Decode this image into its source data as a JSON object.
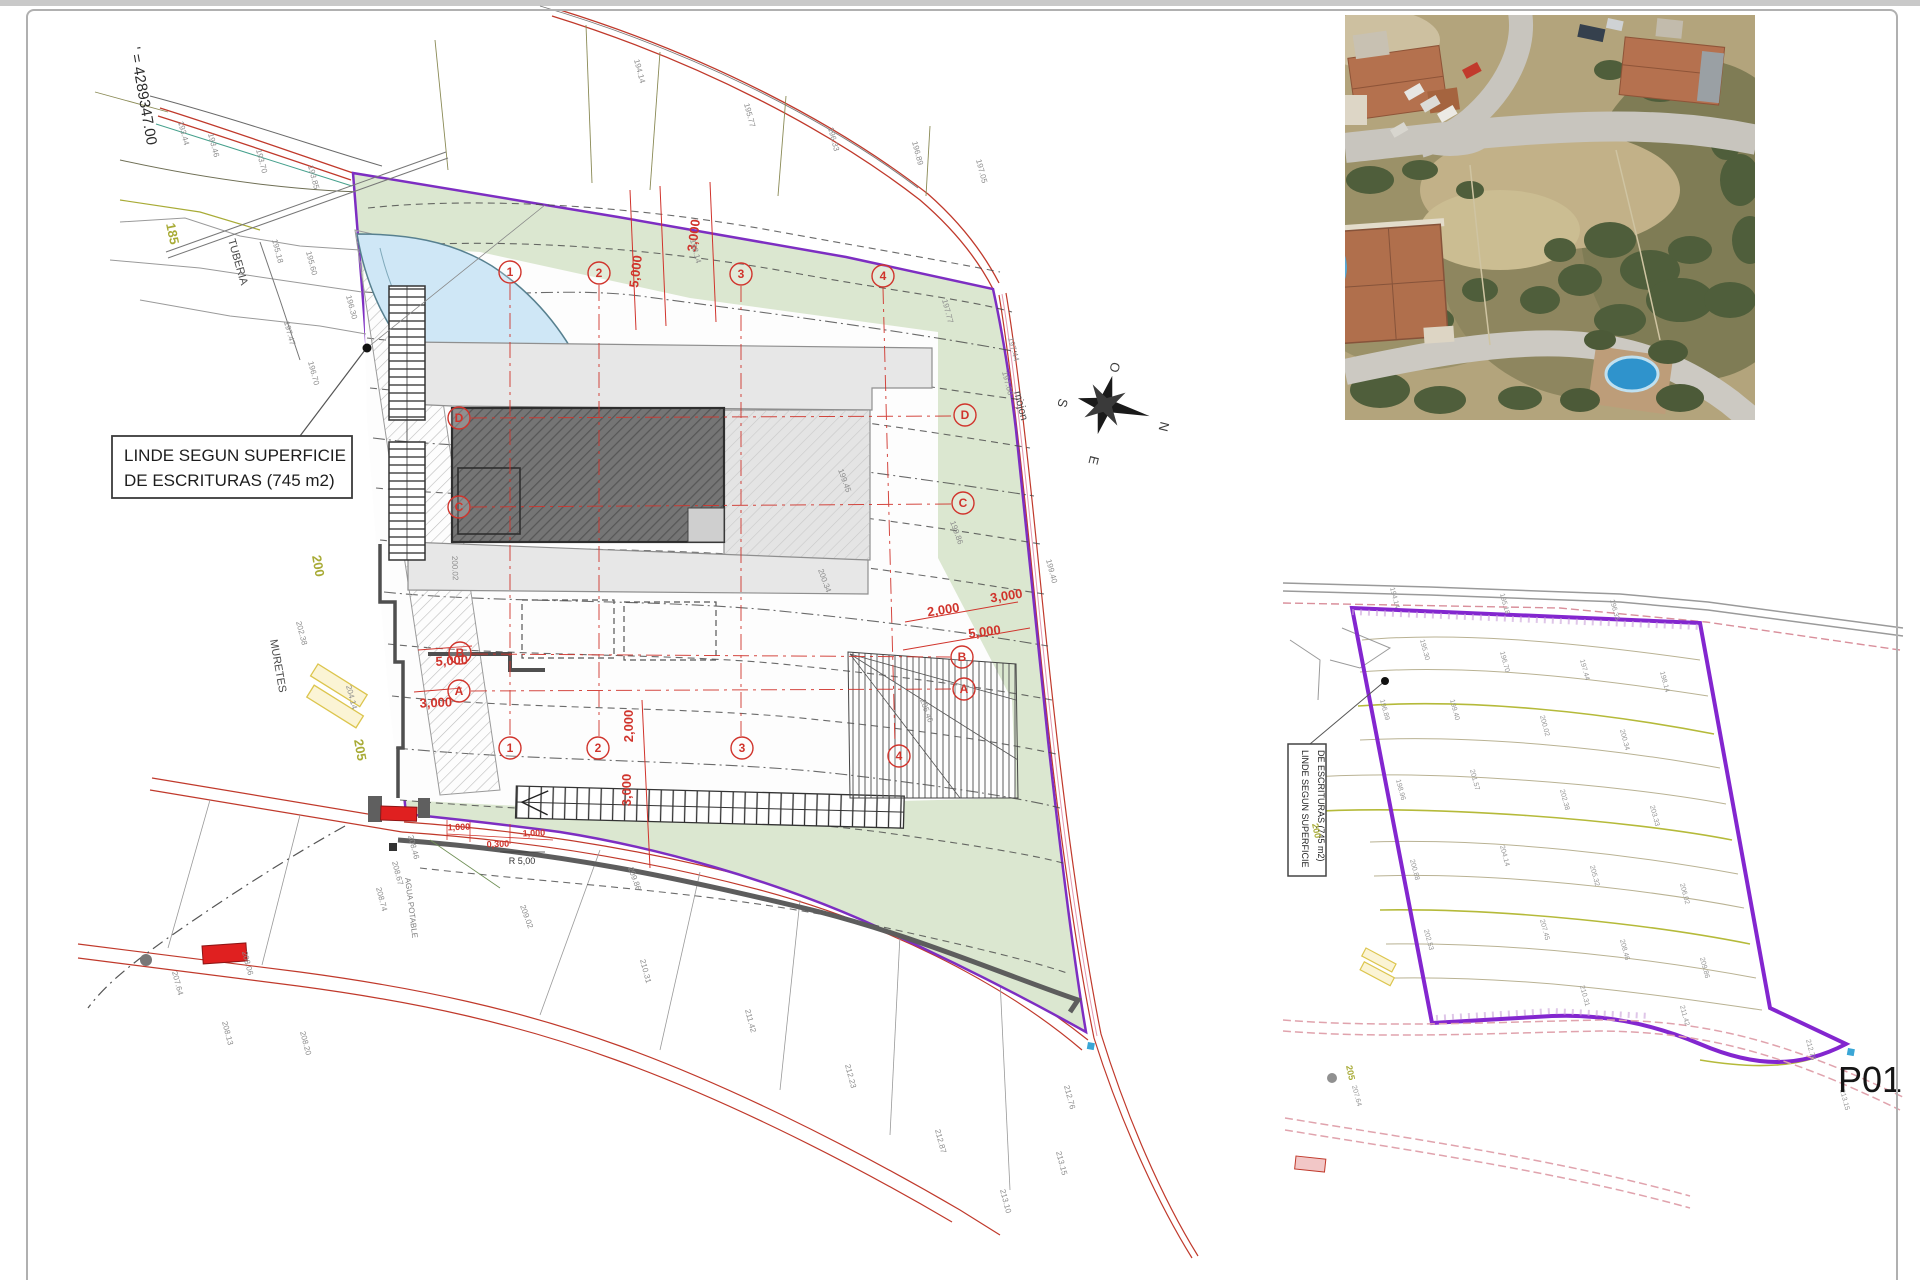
{
  "sheet": {
    "number": "P01"
  },
  "site_plan": {
    "coordinate_label": "' = 4289347.00",
    "texts": {
      "tuberia": "TUBERIA",
      "muretes": "MURETES",
      "mojon": "mojon",
      "agua_potable": "AGUA POTABLE",
      "radius_label": "R 5,00"
    },
    "linde_label": {
      "line1": "LINDE SEGUN SUPERFICIE",
      "line2": "DE ESCRITURAS (745 m2)"
    },
    "compass": {
      "o": "O",
      "n": "N",
      "s": "S",
      "e": "E"
    },
    "contour_labels": [
      {
        "v": "185",
        "x": 166,
        "y": 224,
        "r": 78
      },
      {
        "v": "200",
        "x": 312,
        "y": 556,
        "r": 80
      },
      {
        "v": "205",
        "x": 354,
        "y": 740,
        "r": 80
      }
    ],
    "axis_bubbles": [
      {
        "v": "1",
        "x": 510,
        "y": 272
      },
      {
        "v": "2",
        "x": 599,
        "y": 273
      },
      {
        "v": "3",
        "x": 741,
        "y": 274
      },
      {
        "v": "4",
        "x": 883,
        "y": 276
      },
      {
        "v": "1",
        "x": 510,
        "y": 748
      },
      {
        "v": "2",
        "x": 598,
        "y": 748
      },
      {
        "v": "3",
        "x": 742,
        "y": 748
      },
      {
        "v": "4",
        "x": 899,
        "y": 756
      },
      {
        "v": "D",
        "x": 459,
        "y": 418
      },
      {
        "v": "C",
        "x": 459,
        "y": 507
      },
      {
        "v": "B",
        "x": 460,
        "y": 653
      },
      {
        "v": "A",
        "x": 459,
        "y": 691
      },
      {
        "v": "D",
        "x": 965,
        "y": 415
      },
      {
        "v": "C",
        "x": 963,
        "y": 503
      },
      {
        "v": "B",
        "x": 962,
        "y": 657
      },
      {
        "v": "A",
        "x": 964,
        "y": 689
      }
    ],
    "dimensions": [
      {
        "v": "5,000",
        "x": 640,
        "y": 272,
        "r": -83
      },
      {
        "v": "3,000",
        "x": 698,
        "y": 236,
        "r": -83
      },
      {
        "v": "2,000",
        "x": 944,
        "y": 614,
        "r": -9
      },
      {
        "v": "3,000",
        "x": 1007,
        "y": 600,
        "r": -9
      },
      {
        "v": "5,000",
        "x": 985,
        "y": 636,
        "r": -7
      },
      {
        "v": "5,000",
        "x": 452,
        "y": 665,
        "r": -3
      },
      {
        "v": "3,000",
        "x": 436,
        "y": 707,
        "r": -2
      },
      {
        "v": "2,000",
        "x": 633,
        "y": 726,
        "r": -90
      },
      {
        "v": "3,000",
        "x": 631,
        "y": 790,
        "r": -90
      }
    ],
    "small_dimensions": [
      {
        "v": "1,000",
        "x": 459,
        "y": 830,
        "r": -2
      },
      {
        "v": "0,300",
        "x": 498,
        "y": 847,
        "r": -2
      },
      {
        "v": "1,000",
        "x": 534,
        "y": 836,
        "r": -2
      }
    ],
    "elevations": [
      {
        "v": "193.44",
        "x": 178,
        "y": 122,
        "r": 75
      },
      {
        "v": "193.46",
        "x": 208,
        "y": 134,
        "r": 75
      },
      {
        "v": "193.70",
        "x": 256,
        "y": 150,
        "r": 75
      },
      {
        "v": "193.85",
        "x": 308,
        "y": 166,
        "r": 75
      },
      {
        "v": "194.14",
        "x": 634,
        "y": 60,
        "r": 75
      },
      {
        "v": "195.77",
        "x": 744,
        "y": 104,
        "r": 75
      },
      {
        "v": "196.33",
        "x": 828,
        "y": 128,
        "r": 75
      },
      {
        "v": "196.89",
        "x": 912,
        "y": 142,
        "r": 75
      },
      {
        "v": "197.05",
        "x": 976,
        "y": 160,
        "r": 75
      },
      {
        "v": "195.18",
        "x": 272,
        "y": 240,
        "r": 75
      },
      {
        "v": "195.60",
        "x": 306,
        "y": 252,
        "r": 75
      },
      {
        "v": "196.30",
        "x": 346,
        "y": 296,
        "r": 75
      },
      {
        "v": "197.47",
        "x": 284,
        "y": 322,
        "r": 75
      },
      {
        "v": "196.70",
        "x": 308,
        "y": 362,
        "r": 75
      },
      {
        "v": "197.44",
        "x": 1008,
        "y": 338,
        "r": 75
      },
      {
        "v": "197.60",
        "x": 1002,
        "y": 372,
        "r": 75
      },
      {
        "v": "197.77",
        "x": 942,
        "y": 300,
        "r": 75
      },
      {
        "v": "198.14",
        "x": 690,
        "y": 240,
        "r": 75
      },
      {
        "v": "199.45",
        "x": 838,
        "y": 470,
        "r": 70
      },
      {
        "v": "199.86",
        "x": 950,
        "y": 522,
        "r": 70
      },
      {
        "v": "200.34",
        "x": 818,
        "y": 570,
        "r": 70
      },
      {
        "v": "199.40",
        "x": 1046,
        "y": 560,
        "r": 75
      },
      {
        "v": "200.02",
        "x": 452,
        "y": 556,
        "r": 88
      },
      {
        "v": "202.38",
        "x": 296,
        "y": 622,
        "r": 75
      },
      {
        "v": "204.14",
        "x": 346,
        "y": 686,
        "r": 75
      },
      {
        "v": "205.46",
        "x": 920,
        "y": 700,
        "r": 70
      },
      {
        "v": "208.46",
        "x": 408,
        "y": 836,
        "r": 75
      },
      {
        "v": "208.67",
        "x": 392,
        "y": 862,
        "r": 75
      },
      {
        "v": "208.74",
        "x": 376,
        "y": 888,
        "r": 75
      },
      {
        "v": "209.86",
        "x": 628,
        "y": 868,
        "r": 70
      },
      {
        "v": "209.02",
        "x": 520,
        "y": 906,
        "r": 70
      },
      {
        "v": "207.64",
        "x": 172,
        "y": 972,
        "r": 75
      },
      {
        "v": "208.06",
        "x": 242,
        "y": 952,
        "r": 75
      },
      {
        "v": "208.13",
        "x": 222,
        "y": 1022,
        "r": 75
      },
      {
        "v": "208.20",
        "x": 300,
        "y": 1032,
        "r": 75
      },
      {
        "v": "210.31",
        "x": 640,
        "y": 960,
        "r": 75
      },
      {
        "v": "211.42",
        "x": 745,
        "y": 1010,
        "r": 75
      },
      {
        "v": "212.23",
        "x": 845,
        "y": 1065,
        "r": 75
      },
      {
        "v": "212.87",
        "x": 935,
        "y": 1130,
        "r": 75
      },
      {
        "v": "213.10",
        "x": 1000,
        "y": 1190,
        "r": 75
      },
      {
        "v": "213.15",
        "x": 1056,
        "y": 1152,
        "r": 75
      },
      {
        "v": "212.76",
        "x": 1064,
        "y": 1086,
        "r": 75
      }
    ]
  },
  "detail_plan": {
    "linde_label": {
      "line1": "LINDE SEGUN SUPERFICIE",
      "line2": "DE ESCRITURAS (745 m2)"
    },
    "contour_labels": [
      {
        "v": "200",
        "x": 1312,
        "y": 824,
        "r": 78
      },
      {
        "v": "205",
        "x": 1346,
        "y": 1066,
        "r": 78
      }
    ],
    "elevations": [
      {
        "v": "194.14",
        "x": 1390,
        "y": 588,
        "r": 75
      },
      {
        "v": "195.18",
        "x": 1500,
        "y": 594,
        "r": 75
      },
      {
        "v": "196.33",
        "x": 1610,
        "y": 600,
        "r": 75
      },
      {
        "v": "195.30",
        "x": 1420,
        "y": 640,
        "r": 75
      },
      {
        "v": "196.70",
        "x": 1500,
        "y": 652,
        "r": 75
      },
      {
        "v": "197.44",
        "x": 1580,
        "y": 660,
        "r": 75
      },
      {
        "v": "198.14",
        "x": 1660,
        "y": 672,
        "r": 75
      },
      {
        "v": "199.40",
        "x": 1450,
        "y": 700,
        "r": 75
      },
      {
        "v": "200.02",
        "x": 1540,
        "y": 716,
        "r": 75
      },
      {
        "v": "200.34",
        "x": 1620,
        "y": 730,
        "r": 75
      },
      {
        "v": "201.57",
        "x": 1470,
        "y": 770,
        "r": 75
      },
      {
        "v": "202.38",
        "x": 1560,
        "y": 790,
        "r": 75
      },
      {
        "v": "203.33",
        "x": 1650,
        "y": 806,
        "r": 75
      },
      {
        "v": "204.14",
        "x": 1500,
        "y": 846,
        "r": 75
      },
      {
        "v": "205.32",
        "x": 1590,
        "y": 866,
        "r": 75
      },
      {
        "v": "206.02",
        "x": 1680,
        "y": 884,
        "r": 75
      },
      {
        "v": "207.45",
        "x": 1540,
        "y": 920,
        "r": 75
      },
      {
        "v": "208.46",
        "x": 1620,
        "y": 940,
        "r": 75
      },
      {
        "v": "209.86",
        "x": 1700,
        "y": 958,
        "r": 75
      },
      {
        "v": "210.31",
        "x": 1580,
        "y": 986,
        "r": 75
      },
      {
        "v": "211.42",
        "x": 1680,
        "y": 1006,
        "r": 75
      },
      {
        "v": "196.89",
        "x": 1380,
        "y": 700,
        "r": 75
      },
      {
        "v": "198.96",
        "x": 1396,
        "y": 780,
        "r": 75
      },
      {
        "v": "200.88",
        "x": 1410,
        "y": 860,
        "r": 75
      },
      {
        "v": "202.53",
        "x": 1424,
        "y": 930,
        "r": 75
      },
      {
        "v": "207.64",
        "x": 1352,
        "y": 1086,
        "r": 75
      },
      {
        "v": "212.76",
        "x": 1806,
        "y": 1040,
        "r": 75
      },
      {
        "v": "213.15",
        "x": 1840,
        "y": 1090,
        "r": 75
      }
    ]
  },
  "colors": {
    "boundary_purple": "#7d2ec2",
    "plot_green": "#dbe7d0",
    "road_red": "#c0392b",
    "dimension_red": "#d0342c",
    "contour_olive": "#a8ab36",
    "pool_blue": "#cfe7f6"
  }
}
